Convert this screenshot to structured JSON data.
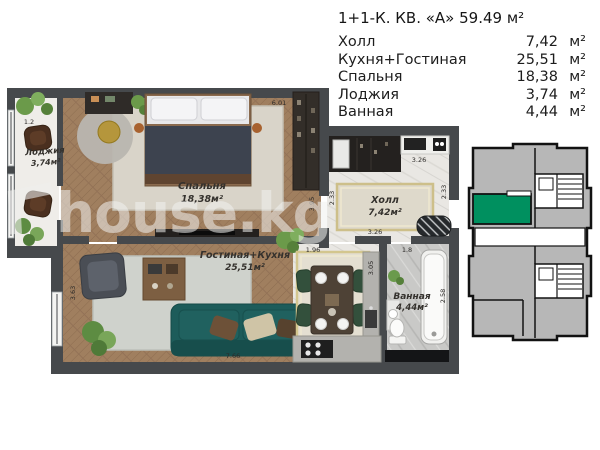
{
  "title": "1+1-К. КВ. «А» 59.49 м²",
  "legend": {
    "rows": [
      {
        "name": "Холл",
        "value": "7,42",
        "unit": "м²"
      },
      {
        "name": "Кухня+Гостиная",
        "value": "25,51",
        "unit": "м²"
      },
      {
        "name": "Спальня",
        "value": "18,38",
        "unit": "м²"
      },
      {
        "name": "Лоджия",
        "value": "3,74",
        "unit": "м²"
      },
      {
        "name": "Ванная",
        "value": "4,44",
        "unit": "м²"
      }
    ]
  },
  "plan": {
    "rooms": {
      "loggia": {
        "label": "Лоджия",
        "area": "3,74м²"
      },
      "bedroom": {
        "label": "Спальня",
        "area": "18,38м²"
      },
      "hall": {
        "label": "Холл",
        "area": "7,42м²"
      },
      "living_kitchen": {
        "label": "Гостиная+Кухня",
        "area": "25,51м²"
      },
      "bathroom": {
        "label": "Ванная",
        "area": "4,44м²"
      }
    },
    "dimensions": {
      "loggia_width": "1.2",
      "bedroom_width": "6.01",
      "bedroom_depth": "3.95",
      "hall_width_top": "3.26",
      "hall_depth_left": "2.33",
      "hall_depth_right": "2.33",
      "hall_width_bottom": "3.26",
      "dining_width": "1.96",
      "bathroom_width": "1.8",
      "kitchen_depth": "3.05",
      "bathroom_depth": "2.58",
      "living_width": "7.66",
      "living_depth": "3.63"
    },
    "watermark": "house.kg"
  },
  "keyplan": {
    "highlight_color": "#00905f"
  },
  "colors": {
    "wall": "#46494c",
    "wood": "#a07f5f",
    "marble": "#e9e7e3",
    "accent": "#00905f"
  }
}
